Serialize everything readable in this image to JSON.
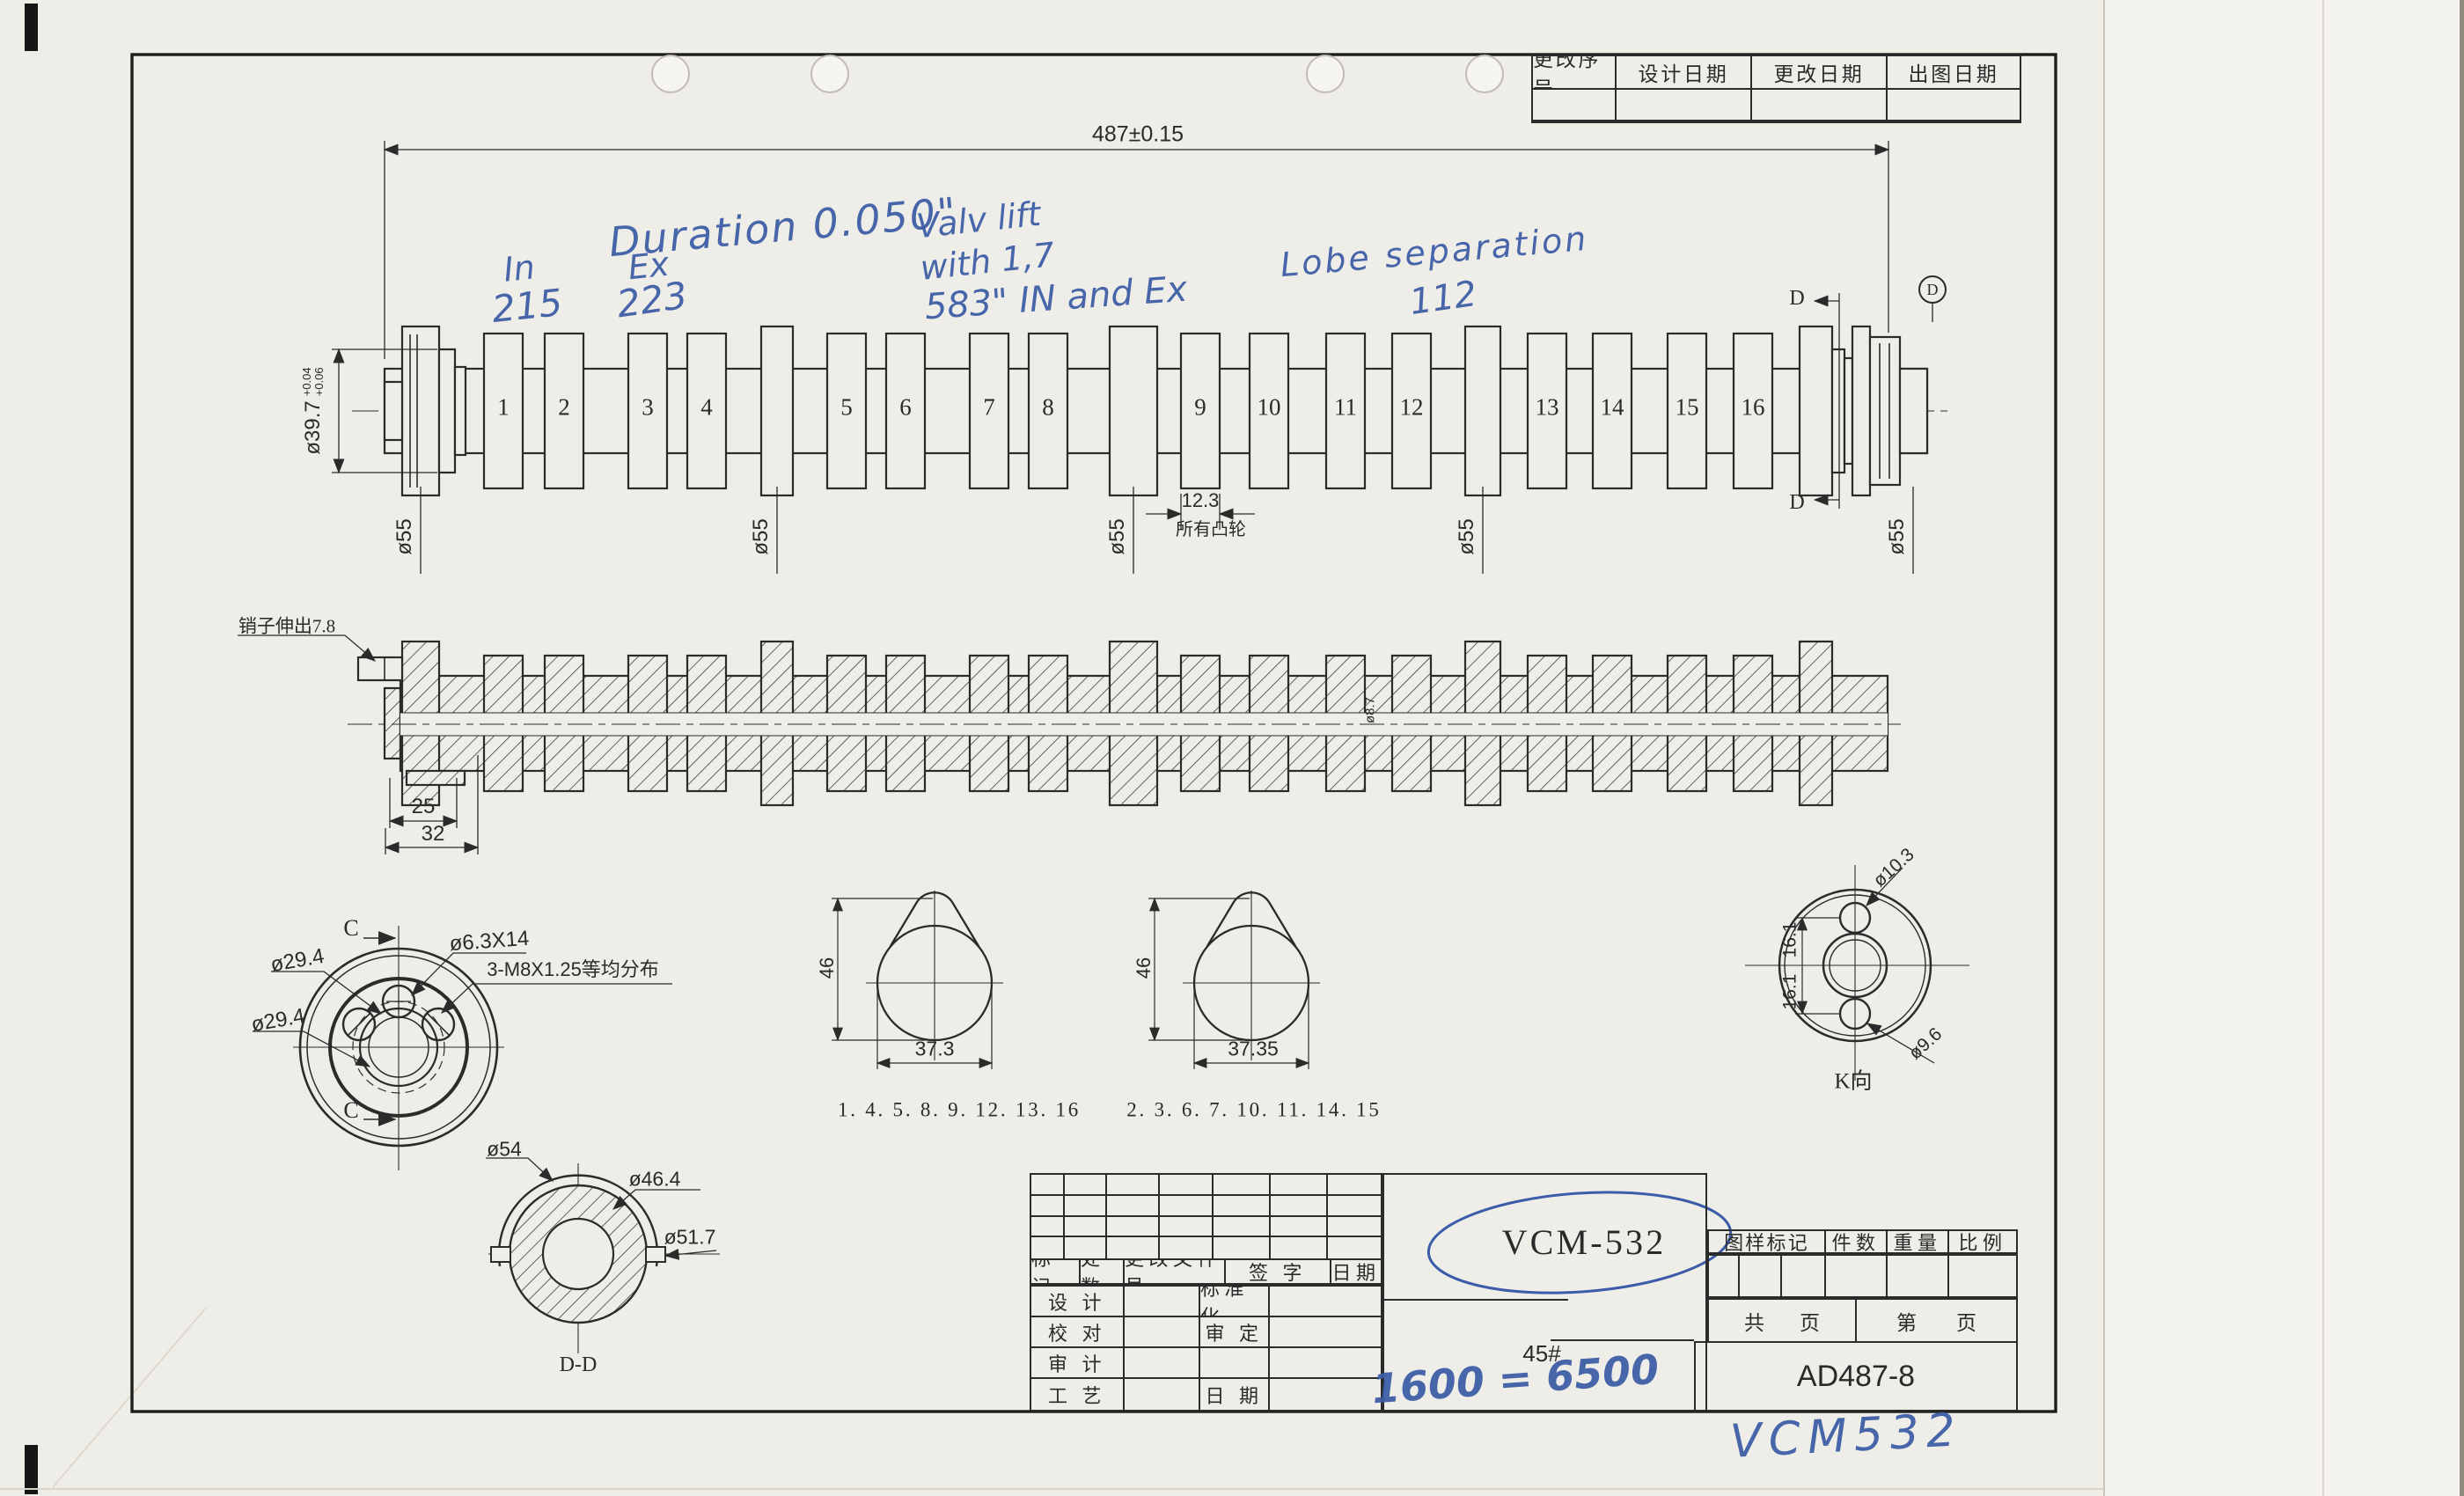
{
  "revision_table": {
    "headers": [
      "更改序号",
      "设计日期",
      "更改日期",
      "出图日期"
    ]
  },
  "handwritten": {
    "duration_line": "Duration 0.050\"",
    "in_label": "In",
    "ex_label": "Ex",
    "in_value": "215",
    "ex_value": "223",
    "lift_line1": "Valv lift",
    "lift_line2": "with 1,7",
    "lift_line3": "583\" IN and Ex",
    "lobe_sep_label": "Lobe separation",
    "lobe_sep_value": "112",
    "rpm_note": "1600 = 6500",
    "part_note": "VCM532"
  },
  "side_view": {
    "overall_length": "487±0.15",
    "nose_dia": "ø39.7",
    "nose_tol_up": "+0.04",
    "nose_tol_low": "+0.06",
    "journal_dia": "ø55",
    "journal_numbers": [
      "1",
      "2",
      "3",
      "4",
      "5",
      "6",
      "7",
      "8",
      "9",
      "10",
      "11",
      "12",
      "13",
      "14",
      "15",
      "16"
    ],
    "lobe_width": "12.3",
    "lobe_width_note": "所有凸轮",
    "section_d": "D",
    "balloon": "D"
  },
  "section_view": {
    "pin_note": "销子伸出7.8",
    "pin_dia": "ø8.7",
    "key_dim1": "25",
    "key_dim2": "32"
  },
  "front_view": {
    "section_c": "C",
    "dia1": "ø29.4",
    "dia2": "ø29.4",
    "hole_spec": "ø6.3X14",
    "thread_spec": "3-M8X1.25等均分布"
  },
  "cam_profiles": {
    "cam1": {
      "height": "46",
      "width": "37.3",
      "lobes": "1. 4. 5. 8. 9. 12. 13. 16"
    },
    "cam2": {
      "height": "46",
      "width": "37.35",
      "lobes": "2. 3. 6. 7. 10. 11. 14. 15"
    }
  },
  "dd_view": {
    "outer_dia": "ø54",
    "bore_dia": "ø46.4",
    "shell_dia": "ø51.7",
    "label": "D-D"
  },
  "k_view": {
    "hole_top_dia": "ø10.3",
    "hole_bottom_dia": "ø9.6",
    "spacing1": "16.1",
    "spacing2": "16.1",
    "label": "K向"
  },
  "title_block": {
    "rev_headers": [
      "标记",
      "处数",
      "更改文件号",
      "签 字",
      "日期"
    ],
    "rows": [
      {
        "left": "设 计",
        "mid": "标准化"
      },
      {
        "left": "校 对",
        "mid": "审 定"
      },
      {
        "left": "审 计",
        "mid": ""
      },
      {
        "left": "工 艺",
        "mid": "日 期"
      }
    ],
    "stamp": "VCM-532",
    "material": "45#",
    "spec_headers": [
      "图样标记",
      "件数",
      "重量",
      "比例"
    ],
    "pages_total_label": "共",
    "pages_total_unit": "页",
    "pages_current_label": "第",
    "pages_current_unit": "页",
    "drawing_no": "AD487-8"
  }
}
